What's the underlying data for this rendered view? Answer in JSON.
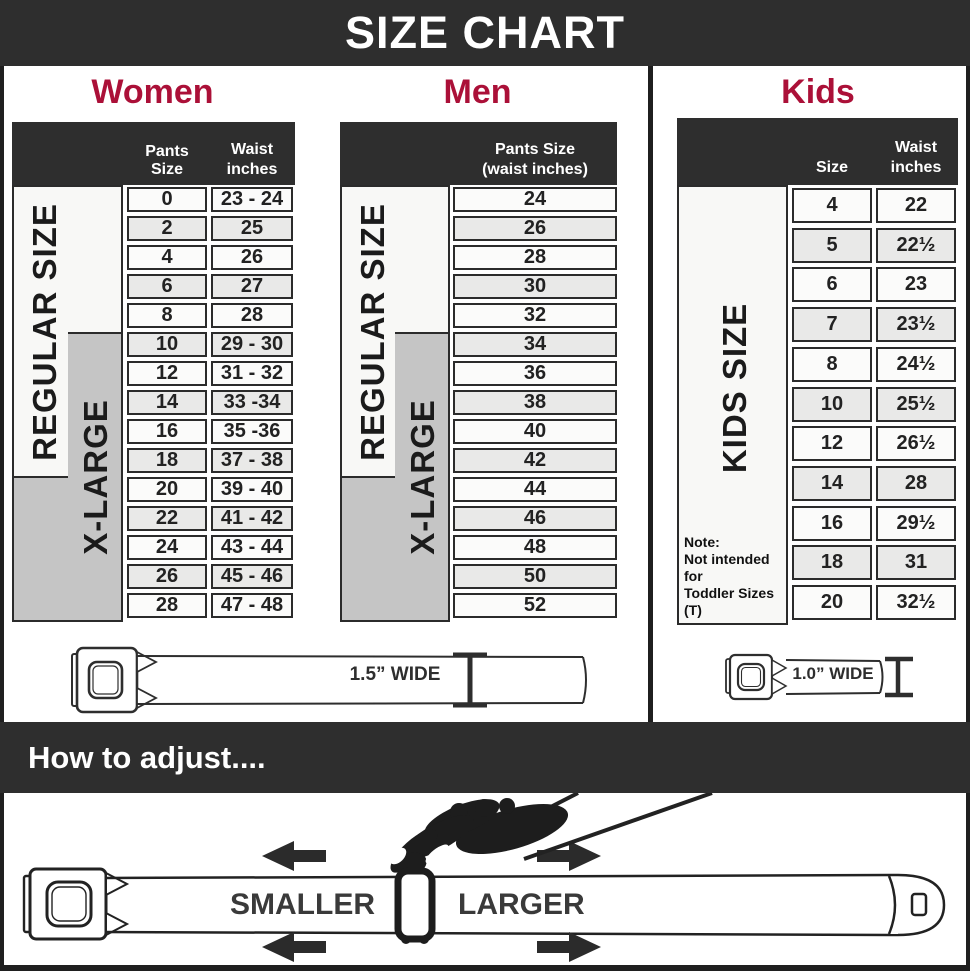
{
  "title": "SIZE CHART",
  "colors": {
    "accent": "#ab1038",
    "band": "#2e2e2e",
    "gray_box": "#c5c5c5",
    "row_alt": "#e9e9e8"
  },
  "women": {
    "heading": "Women",
    "col1_header": "Pants Size",
    "col2_header_line1": "Waist",
    "col2_header_line2": "inches",
    "label_regular": "REGULAR SIZE",
    "label_xlarge": "X-LARGE",
    "rows": [
      {
        "size": "0",
        "waist": "23 - 24"
      },
      {
        "size": "2",
        "waist": "25"
      },
      {
        "size": "4",
        "waist": "26"
      },
      {
        "size": "6",
        "waist": "27"
      },
      {
        "size": "8",
        "waist": "28"
      },
      {
        "size": "10",
        "waist": "29 - 30"
      },
      {
        "size": "12",
        "waist": "31 - 32"
      },
      {
        "size": "14",
        "waist": "33 -34"
      },
      {
        "size": "16",
        "waist": "35 -36"
      },
      {
        "size": "18",
        "waist": "37 - 38"
      },
      {
        "size": "20",
        "waist": "39 - 40"
      },
      {
        "size": "22",
        "waist": "41 - 42"
      },
      {
        "size": "24",
        "waist": "43 - 44"
      },
      {
        "size": "26",
        "waist": "45 - 46"
      },
      {
        "size": "28",
        "waist": "47 - 48"
      }
    ],
    "belt_width_label": "1.5” WIDE"
  },
  "men": {
    "heading": "Men",
    "col_header_line1": "Pants Size",
    "col_header_line2": "(waist inches)",
    "label_regular": "REGULAR SIZE",
    "label_xlarge": "X-LARGE",
    "rows": [
      "24",
      "26",
      "28",
      "30",
      "32",
      "34",
      "36",
      "38",
      "40",
      "42",
      "44",
      "46",
      "48",
      "50",
      "52"
    ]
  },
  "kids": {
    "heading": "Kids",
    "col1_header": "Size",
    "col2_header_line1": "Waist",
    "col2_header_line2": "inches",
    "label": "KIDS SIZE",
    "note_line1": "Note:",
    "note_line2": "Not intended for",
    "note_line3": "Toddler Sizes (T)",
    "rows": [
      {
        "size": "4",
        "waist": "22"
      },
      {
        "size": "5",
        "waist": "22½"
      },
      {
        "size": "6",
        "waist": "23"
      },
      {
        "size": "7",
        "waist": "23½"
      },
      {
        "size": "8",
        "waist": "24½"
      },
      {
        "size": "10",
        "waist": "25½"
      },
      {
        "size": "12",
        "waist": "26½"
      },
      {
        "size": "14",
        "waist": "28"
      },
      {
        "size": "16",
        "waist": "29½"
      },
      {
        "size": "18",
        "waist": "31"
      },
      {
        "size": "20",
        "waist": "32½"
      }
    ],
    "belt_width_label": "1.0” WIDE"
  },
  "adjust": {
    "heading": "How to adjust....",
    "smaller_label": "SMALLER",
    "larger_label": "LARGER"
  }
}
